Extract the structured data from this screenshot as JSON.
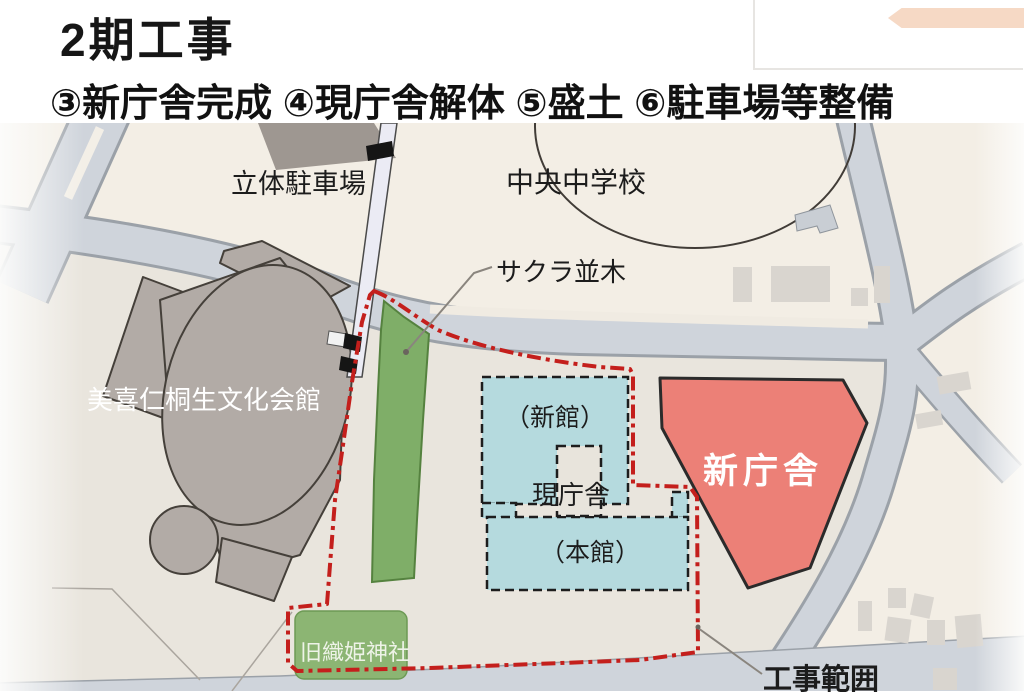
{
  "header": {
    "title": "2期工事",
    "subtitle": "③新庁舎完成 ④現庁舎解体 ⑤盛土 ⑥駐車場等整備"
  },
  "map": {
    "labels": {
      "parking_garage": "立体駐車場",
      "school": "中央中学校",
      "cherry_tree_row": "サクラ並木",
      "cultural_hall": "美喜仁桐生文化会館",
      "current_hall": "現庁舎",
      "new_wing": "（新館）",
      "main_wing": "（本館）",
      "new_building": "新庁舎",
      "old_shrine": "旧織姫神社",
      "construction_area": "工事範囲"
    },
    "colors": {
      "background_cream": "#f3eee5",
      "site_ground": "#e9e5dd",
      "road": "#cfd4db",
      "road_casing": "#9ba1a8",
      "new_building_fill": "#ec8077",
      "current_building_fill": "#b5dade",
      "greenery_fill": "#7fae68",
      "shrine_fill": "#8cb573",
      "building_gray": "#b2aba6",
      "boundary_red": "#c41f1c"
    }
  }
}
